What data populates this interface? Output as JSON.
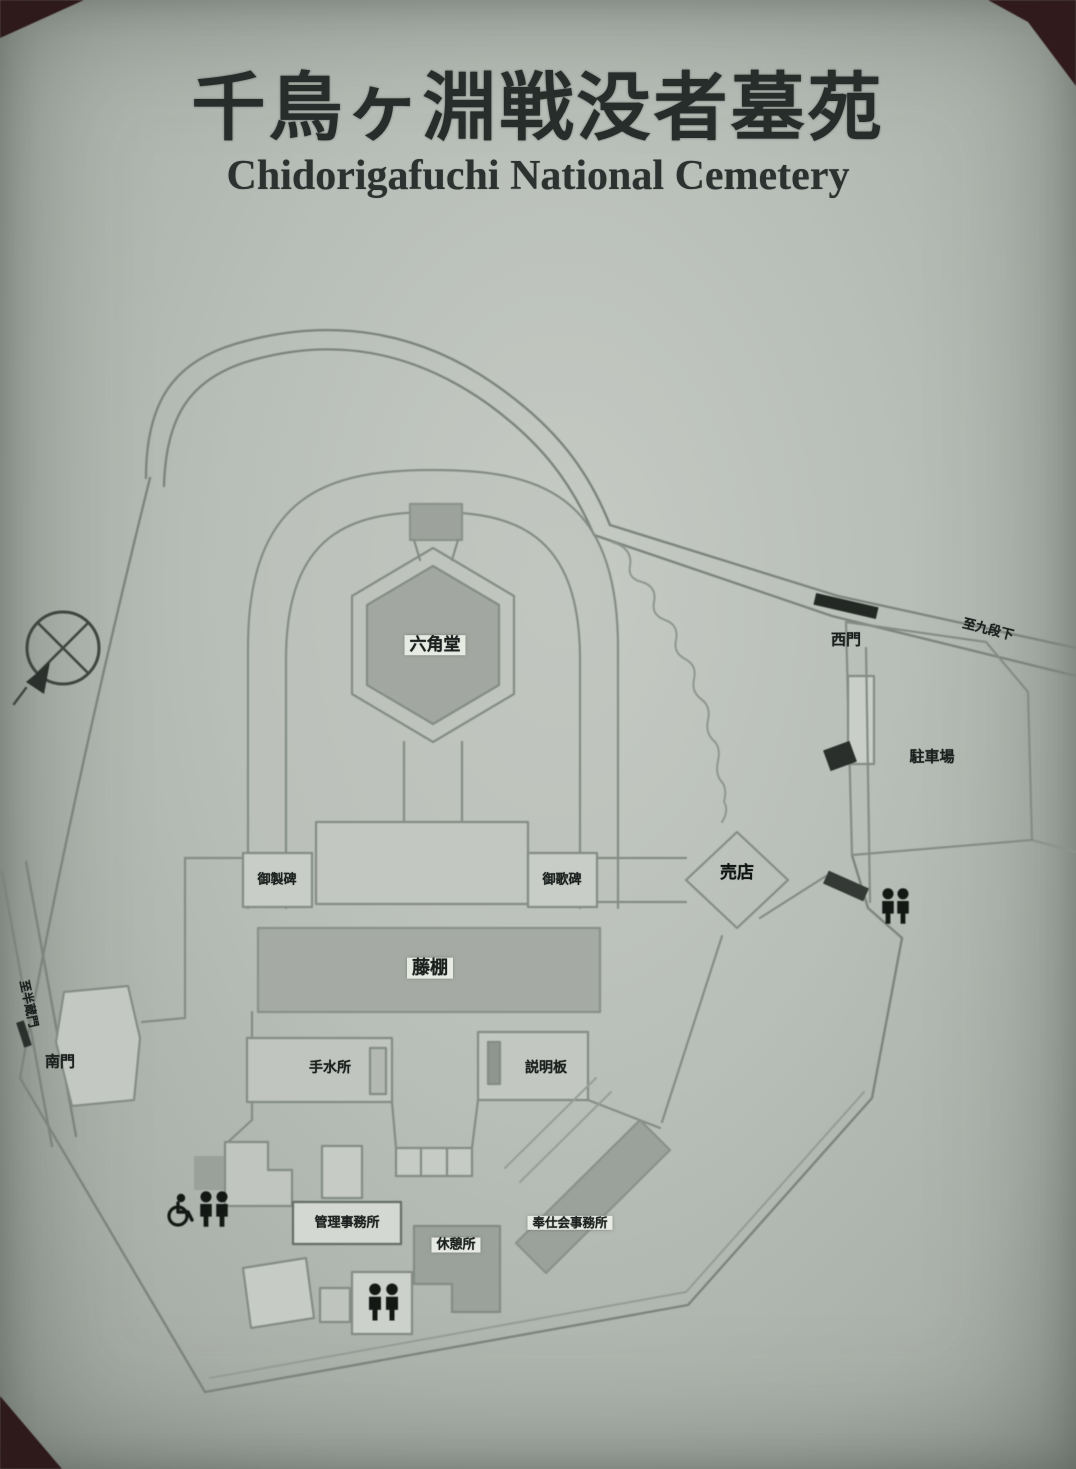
{
  "header": {
    "title_ja": "千鳥ヶ淵戦没者墓苑",
    "title_en": "Chidorigafuchi National Cemetery"
  },
  "map": {
    "labels": {
      "hexagon_hall": "六角堂",
      "monument_left": "御製碑",
      "monument_right": "御歌碑",
      "trellis": "藤棚",
      "water_basin": "手水所",
      "info_board": "説明板",
      "south_gate": "南門",
      "west_gate": "西門",
      "parking": "駐車場",
      "shop": "売店",
      "admin_office": "管理事務所",
      "rest_area": "休憩所",
      "service_office": "奉仕会事務所",
      "road_to_right": "至九段下",
      "road_to_left": "至半蔵門"
    },
    "icons": {
      "compass": "compass-rose-icon",
      "wheelchair": "wheelchair-icon",
      "restrooms": "toilet-icon"
    },
    "colors": {
      "sign_background": "#b6bcb6",
      "map_line": "#858c86",
      "building_fill": "#a2a8a1",
      "label_text": "#1c211f",
      "dark_marker": "#232824",
      "photo_corner": "#2e191b"
    }
  }
}
